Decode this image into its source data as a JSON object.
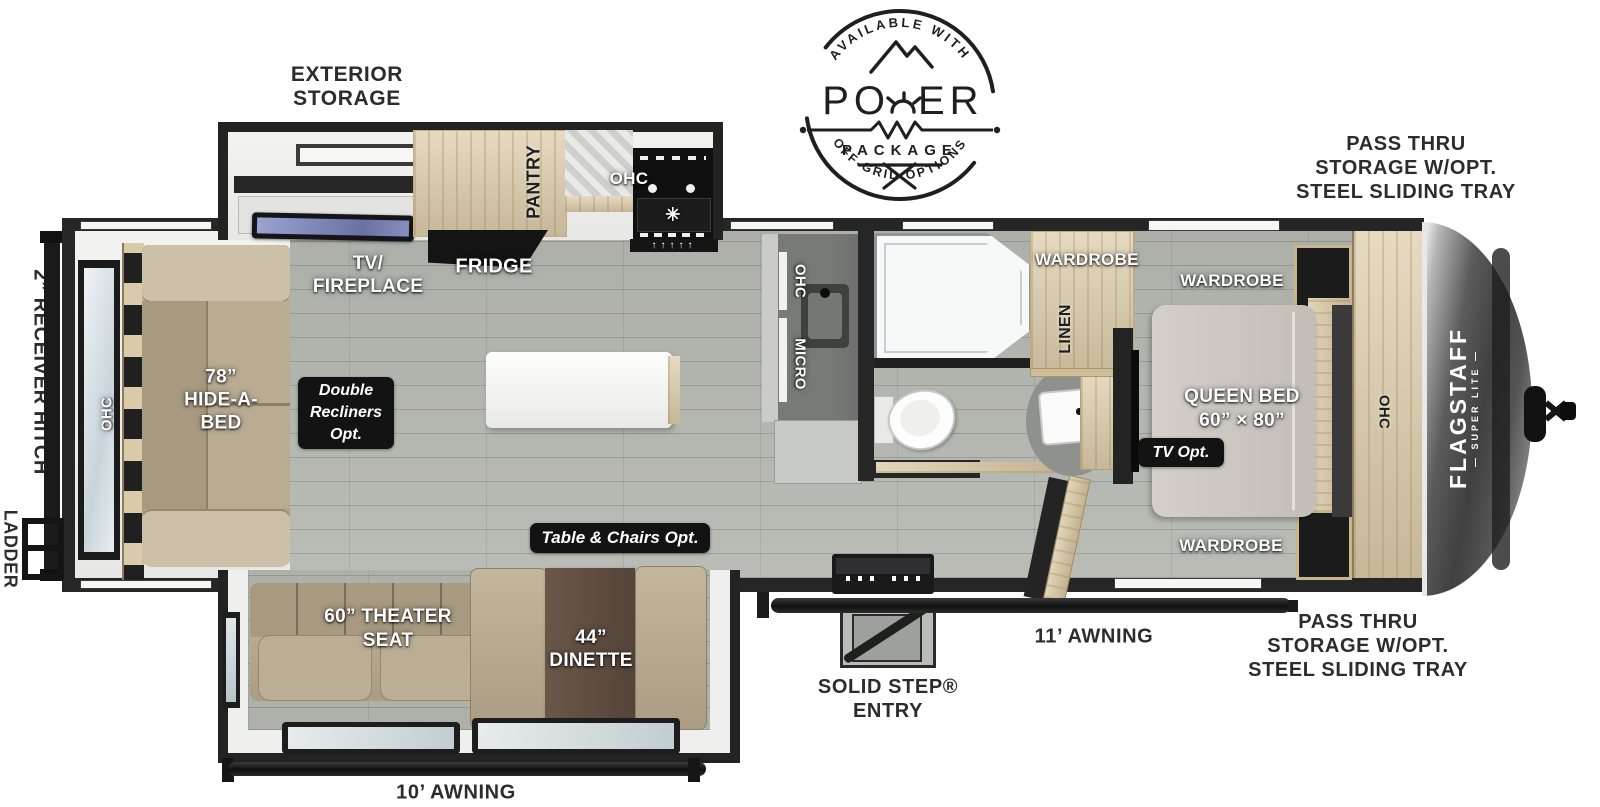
{
  "power_logo": {
    "arc_top": "AVAILABLE WITH",
    "word_left": "PO",
    "word_right": "ER",
    "package": "PACKAGE",
    "arc_bottom": "OFF-GRID OPTIONS"
  },
  "brand": {
    "name": "FLAGSTAFF",
    "sub": "— SUPER LITE —"
  },
  "exterior": {
    "exterior_storage": [
      "EXTERIOR",
      "STORAGE"
    ],
    "pass_thru_top": [
      "PASS THRU",
      "STORAGE W/OPT.",
      "STEEL SLIDING TRAY"
    ],
    "pass_thru_bottom": [
      "PASS THRU",
      "STORAGE W/OPT.",
      "STEEL SLIDING TRAY"
    ],
    "receiver_hitch": "2” RECEIVER HITCH",
    "ladder": "LADDER",
    "awning_11": "11’ AWNING",
    "awning_10": "10’ AWNING",
    "solid_step": [
      "SOLID STEP®",
      "ENTRY"
    ]
  },
  "living": {
    "hide_a_bed": [
      "78”",
      "HIDE-A-",
      "BED"
    ],
    "ohc_rear": "OHC",
    "tv_fireplace": [
      "TV/",
      "FIREPLACE"
    ],
    "fridge": "FRIDGE",
    "pantry": "PANTRY",
    "ohc_range": "OHC",
    "ohc_counter": "OHC",
    "micro": "MICRO",
    "theater_seat": [
      "60” THEATER",
      "SEAT"
    ],
    "dinette": [
      "44”",
      "DINETTE"
    ]
  },
  "bedroom": {
    "wardrobe_hall": "WARDROBE",
    "linen": "LINEN",
    "wardrobe_top": "WARDROBE",
    "wardrobe_bottom": "WARDROBE",
    "queen_bed": [
      "QUEEN BED",
      "60” × 80”"
    ],
    "ohc_front": "OHC"
  },
  "badges": {
    "double_recliners": [
      "Double",
      "Recliners",
      "Opt."
    ],
    "table_chairs": "Table & Chairs Opt.",
    "tv_opt": "TV Opt."
  }
}
